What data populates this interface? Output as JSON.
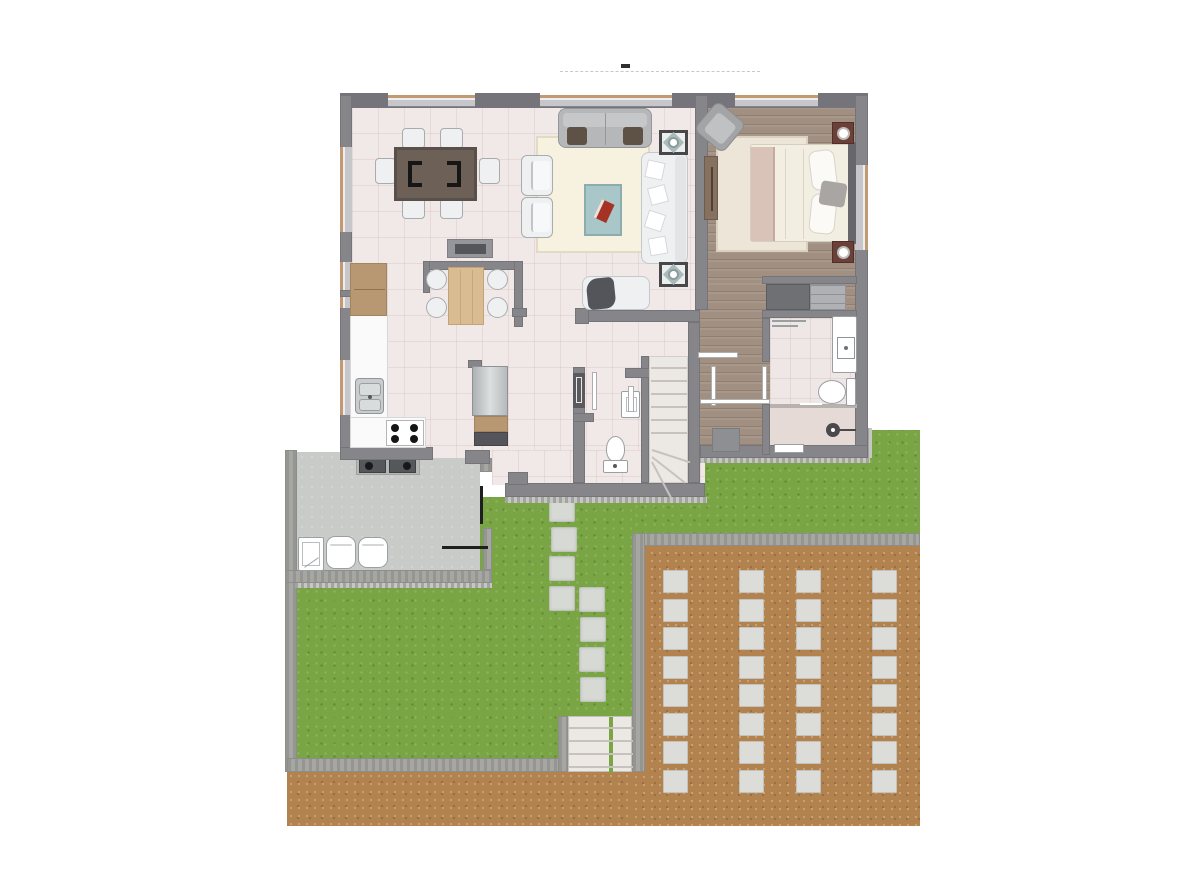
{
  "scene": {
    "width": 1200,
    "height": 887,
    "background": "#ffffff",
    "kind": "architectural-floor-plan-top-view",
    "visible_text": "none"
  },
  "palette": {
    "wall": "#85858a",
    "wall_dark": "#74747a",
    "window": "#c7c7cb",
    "window_sill": "#c29a72",
    "tile": "#f1e9e8",
    "rug_living": "#f7f2e0",
    "rug_bedroom": "#ece5d8",
    "wood": "#a19082",
    "bath_tile": "#eee7e5",
    "shower_tile": "#e6dad6",
    "garden_wall": "#a6a6a3",
    "garden_wall_edge": "#8d8d8a",
    "grass": "#7aa544",
    "dirt": "#b2824f",
    "paver": "#dcdcd8",
    "paver_edge": "#c2c2be",
    "patio_floor": "#c8cbc7",
    "counter": "#fafafa",
    "wood_cab": "#b89872",
    "steel": "#c9cdce",
    "sofa_grey": "#b6b7b9",
    "sofa_white": "#eff0f2",
    "armrest_brown": "#5e5247",
    "coffee_table": "#a9c6c8",
    "accent_red": "#a63226",
    "dining_table": "#6d6057",
    "chair_white": "#eff0f1",
    "bed_duvet": "#f3eee2",
    "bed_blanket": "#d9c2b8",
    "headboard": "#66666b",
    "nightstand": "#6a4038",
    "appliance_dark": "#55585a",
    "closet_dark": "#6f7073",
    "closet_light": "#b0b1b4",
    "fixture_white": "#ffffff",
    "fixture_line": "#9aa0a2",
    "stair": "#ece8e4",
    "stair_line": "#c7c2bd",
    "door_leaf": "#ffffff",
    "door_leaf_edge": "#aeaeae",
    "door_black": "#1f1f1f",
    "mat_grey": "#8e8f93"
  },
  "driveway": {
    "paver_columns_x": [
      663,
      739,
      796,
      872
    ],
    "paver_rows": 8,
    "row_start_y": 570,
    "row_pitch": 28.5,
    "paver_w": 25,
    "paver_h": 23
  },
  "garden_path": {
    "stone_w": 26,
    "stone_h": 25,
    "stones": [
      [
        549,
        497
      ],
      [
        551,
        527
      ],
      [
        549,
        556
      ],
      [
        549,
        586
      ],
      [
        579,
        587
      ],
      [
        580,
        617
      ],
      [
        579,
        647
      ],
      [
        580,
        677
      ]
    ]
  },
  "garden_steps": {
    "tread_count": 4
  },
  "interior_stairs": {
    "tread_count": 6,
    "winder_count": 3
  },
  "counts": {
    "dining_chairs": 6,
    "kitchen_chairs": 4,
    "stove_burners": 4,
    "floor_speakers": 2,
    "laundry_tanks": 2,
    "nightstands": 2,
    "closet_units": 2
  }
}
